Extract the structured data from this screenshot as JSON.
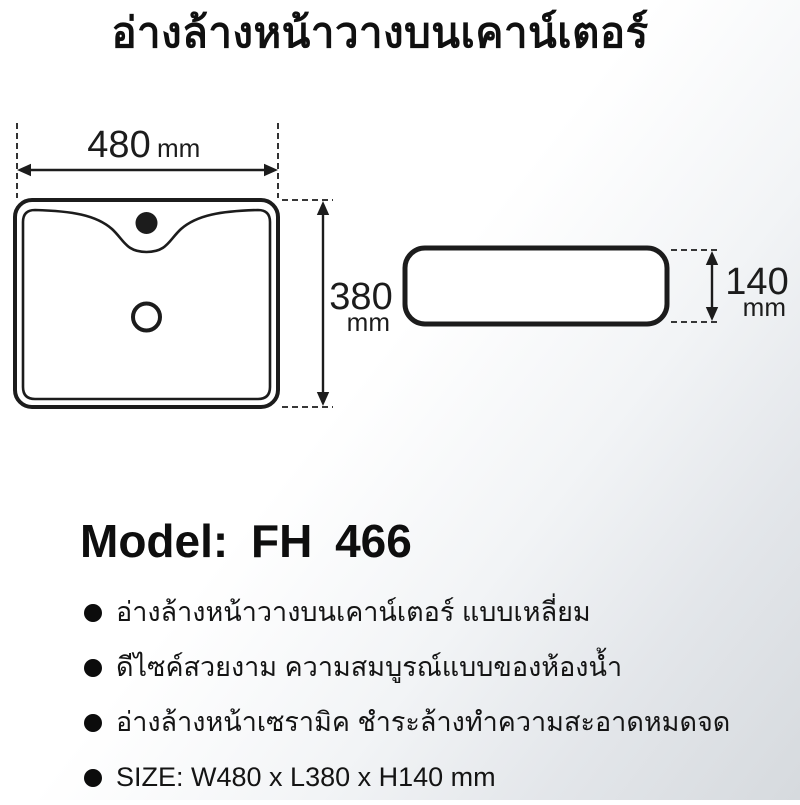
{
  "title": "อ่างล้างหน้าวางบนเคาน์เตอร์",
  "model_line": "Model: FH 466",
  "dimensions": {
    "width": {
      "value": "480",
      "unit": "mm"
    },
    "depth": {
      "value": "380",
      "unit": "mm"
    },
    "height": {
      "value": "140",
      "unit": "mm"
    }
  },
  "features": [
    "อ่างล้างหน้าวางบนเคาน์เตอร์ แบบเหลี่ยม",
    "ดีไซค์สวยงาม ความสมบูรณ์แบบของห้องน้ำ",
    "อ่างล้างหน้าเซรามิค ชำระล้างทำความสะอาดหมดจด",
    "SIZE: W480 x L380 x H140 mm"
  ],
  "colors": {
    "line": "#1c1c1c",
    "text": "#141414",
    "background_top": "#ffffff",
    "background_bottom": "#d6dade"
  }
}
